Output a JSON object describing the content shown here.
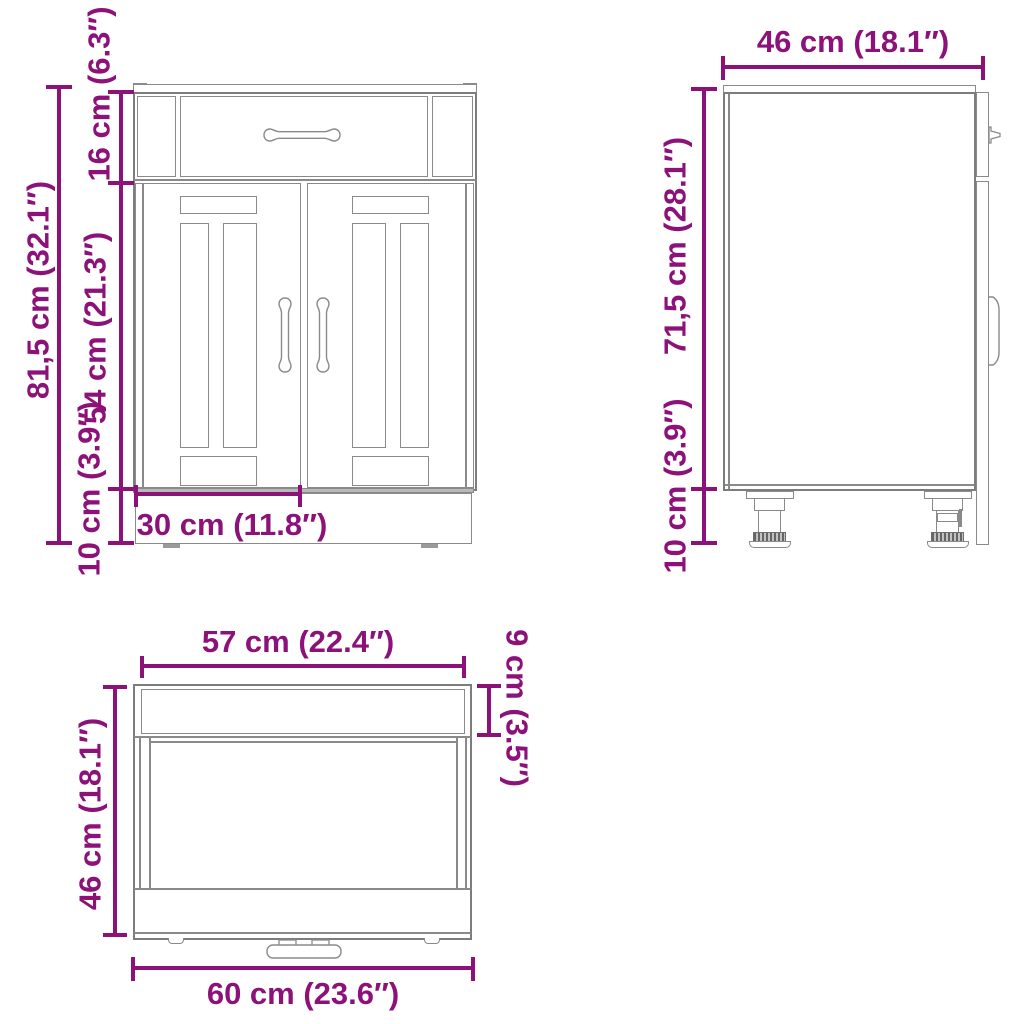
{
  "diagram": {
    "type": "furniture-technical-drawing",
    "subject": "kitchen base cabinet with one drawer and two panelled doors, three orthographic views",
    "colors": {
      "dimension": "#8C1179",
      "line": "#8A8A8A",
      "line_dark": "#7D7D7D",
      "background": "#FFFFFF"
    },
    "views": {
      "front": {
        "name": "front view",
        "dims": {
          "total_height": "81,5 cm (32.1″)",
          "drawer_height": "16 cm (6.3″)",
          "doors_height": "54 cm (21.3″)",
          "plinth_height": "10 cm (3.9″)",
          "door_width": "30 cm (11.8″)"
        }
      },
      "side": {
        "name": "side view",
        "dims": {
          "depth": "46 cm (18.1″)",
          "body_height": "71,5 cm (28.1″)",
          "feet_height": "10 cm (3.9″)"
        }
      },
      "top": {
        "name": "top view",
        "dims": {
          "front_width": "57 cm (22.4″)",
          "front_depth": "9 cm (3.5″)",
          "depth": "46 cm (18.1″)",
          "total_width": "60 cm (23.6″)"
        }
      }
    }
  }
}
